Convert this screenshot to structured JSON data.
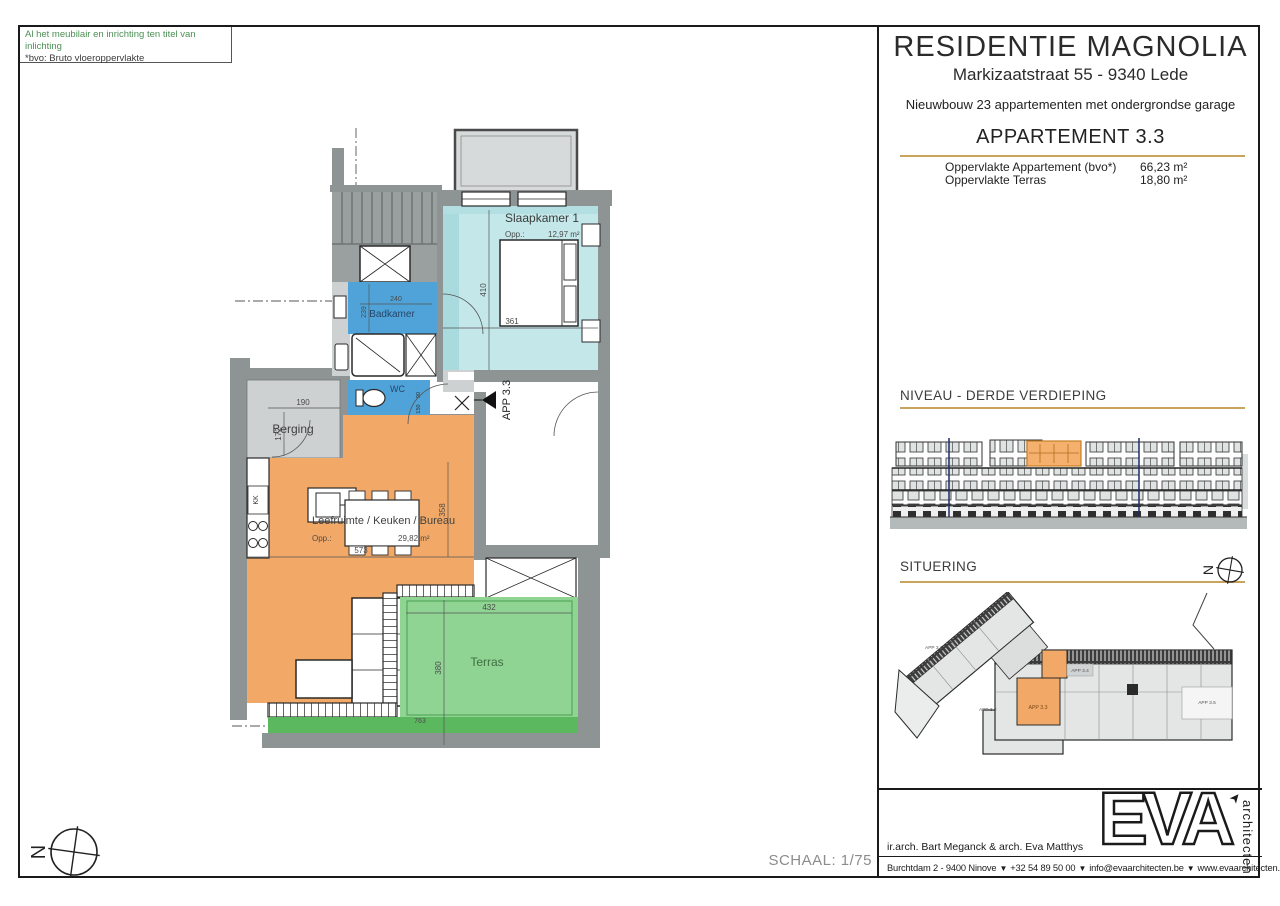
{
  "notes": {
    "line1": "Al het meubilair en inrichting ten titel van inlichting",
    "line2": "*bvo: Bruto vloeroppervlakte"
  },
  "panel": {
    "title": "RESIDENTIE MAGNOLIA",
    "address": "Markizaatstraat 55 - 9340 Lede",
    "subtitle": "Nieuwbouw 23 appartementen met ondergrondse garage",
    "apartment_title": "APPARTEMENT 3.3",
    "area_rows": [
      {
        "label": "Oppervlakte Appartement (bvo*)",
        "value": "66,23 m²"
      },
      {
        "label": "Oppervlakte Terras",
        "value": "18,80 m²"
      }
    ],
    "section_niveau": "NIVEAU - DERDE VERDIEPING",
    "section_situering": "SITUERING"
  },
  "plan": {
    "schaal": "SCHAAL: 1/75",
    "north": "N",
    "app_marker": "APP 3.3",
    "rooms": {
      "slaapkamer": "Slaapkamer 1",
      "slaapkamer_opp_label": "Opp.:",
      "slaapkamer_opp": "12,97 m²",
      "badkamer": "Badkamer",
      "wc": "WC",
      "hal": "Hal",
      "berging": "Berging",
      "leefruimte": "Leefruimte / Keuken / Bureau",
      "leefruimte_opp_label": "Opp.:",
      "leefruimte_opp": "29,82 m²",
      "terras": "Terras",
      "koelkast": "KK"
    },
    "dims": {
      "bedroom_w": "361",
      "bedroom_h": "410",
      "bad_w": "240",
      "bad_h": "239",
      "wc_d1": "90",
      "wc_d2": "150",
      "berging_w": "190",
      "berging_h": "172",
      "living_w": "573",
      "living_h": "358",
      "terras_w": "432",
      "terras_h": "380",
      "terras_total": "763"
    }
  },
  "situering": {
    "north": "N",
    "app31": "APP 3.1",
    "app32": "APP 3.2",
    "app33": "APP 3.3",
    "app34": "APP 3.4",
    "app35": "APP 3.5"
  },
  "footer": {
    "logo": "EVA",
    "logo_sub": "architecten",
    "logo_arrow": "➤",
    "architects": "ir.arch. Bart Meganck & arch. Eva Matthys",
    "contact_address": "Burchtdam 2 - 9400 Ninove",
    "contact_phone": "+32 54 89 50 00",
    "contact_email": "info@evaarchitecten.be",
    "contact_web": "www.evaarchitecten.be",
    "flag_icon": "▼"
  },
  "colors": {
    "accent_gold": "#c9a45c",
    "highlight_orange": "#f2a967",
    "room_cyan": "#c4e8ea",
    "room_blue": "#4fa3d8",
    "room_green": "#90d494"
  }
}
